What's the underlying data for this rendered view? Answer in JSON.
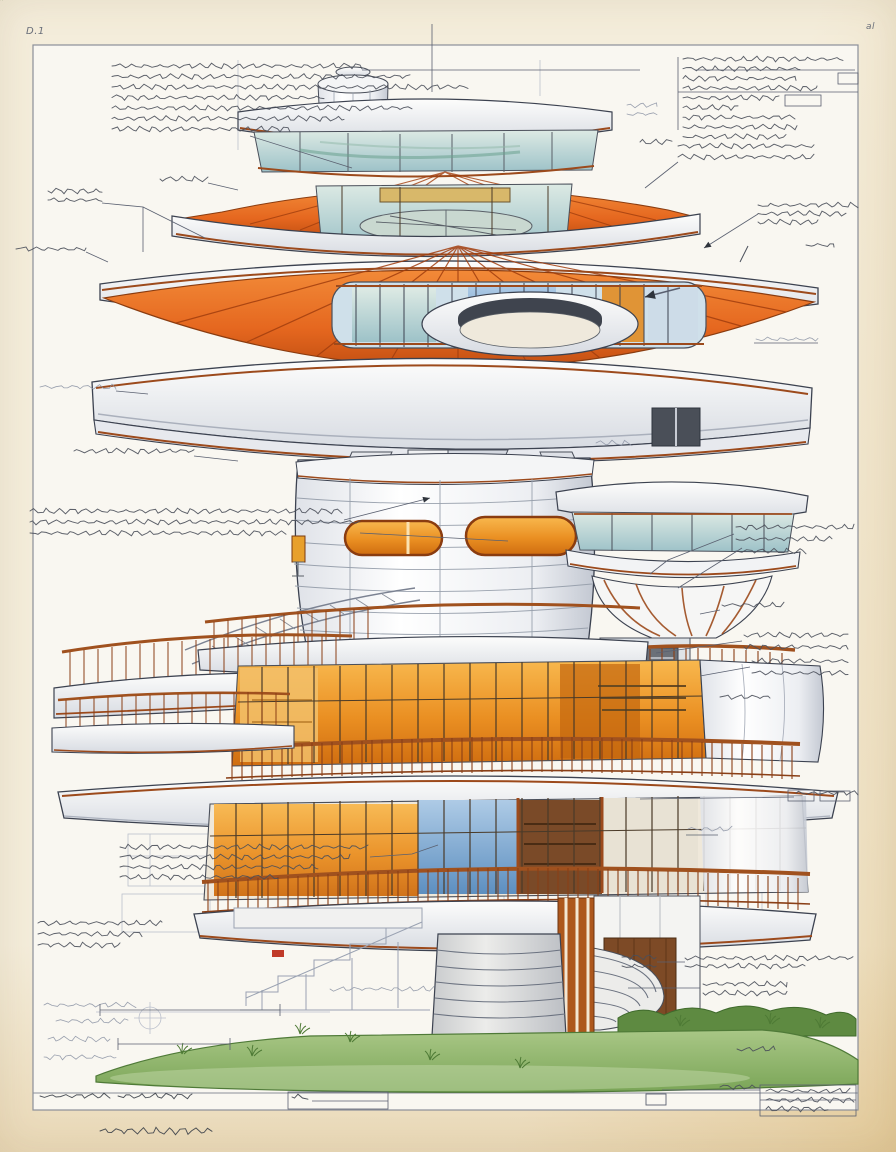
{
  "sheet": {
    "label_top_left": "D.1",
    "label_top_right": "al",
    "palette": {
      "paper_margin": "#f3ead6",
      "paper_inner": "#f9f7f1",
      "frame_line": "#8b8f99",
      "accent_orange": "#e66c22",
      "orange_deep": "#c05314",
      "trim_sienna": "#9c4a1c",
      "ink": "#4a4f5a",
      "pencil": "#8e96a6",
      "dark": "#3a3f48",
      "glass_teal": "#b9d6d4",
      "glass_blue": "#6fa3cf",
      "interior_glow": "#eb9026",
      "grass_green": "#8fb468",
      "concrete": "#d6d8da"
    },
    "annotations": [
      {
        "x": 112,
        "y": 66,
        "w": 250,
        "rows": 7,
        "gap": 10.5,
        "c": "ink",
        "widths": [
          250,
          298,
          356,
          212,
          300,
          232,
          178
        ]
      },
      {
        "x": 683,
        "y": 59,
        "w": 160,
        "rows": 9,
        "gap": 9.7,
        "c": "ink",
        "widths": [
          160,
          117,
          113,
          134,
          96,
          55,
          112,
          114,
          103
        ]
      },
      {
        "x": 678,
        "y": 146,
        "w": 136,
        "rows": 2,
        "gap": 11,
        "c": "ink"
      },
      {
        "x": 640,
        "y": 142,
        "w": 32,
        "rows": 1,
        "gap": 10,
        "c": "ink"
      },
      {
        "x": 627,
        "y": 105,
        "w": 30,
        "rows": 2,
        "gap": 9,
        "c": "pencil"
      },
      {
        "x": 758,
        "y": 205,
        "w": 100,
        "rows": 3,
        "gap": 8.5,
        "c": "ink",
        "widths": [
          100,
          88,
          60
        ]
      },
      {
        "x": 806,
        "y": 245,
        "w": 28,
        "rows": 1,
        "gap": 10,
        "c": "ink"
      },
      {
        "x": 160,
        "y": 179,
        "w": 48,
        "rows": 1,
        "gap": 10,
        "c": "ink"
      },
      {
        "x": 48,
        "y": 191,
        "w": 54,
        "rows": 2,
        "gap": 9,
        "c": "ink"
      },
      {
        "x": 16,
        "y": 249,
        "w": 70,
        "rows": 1,
        "gap": 10,
        "c": "ink"
      },
      {
        "x": 40,
        "y": 387,
        "w": 76,
        "rows": 1,
        "gap": 10,
        "c": "pencil"
      },
      {
        "x": 74,
        "y": 451,
        "w": 120,
        "rows": 1,
        "gap": 10,
        "c": "ink"
      },
      {
        "x": 30,
        "y": 511,
        "w": 312,
        "rows": 3,
        "gap": 11,
        "c": "ink",
        "widths": [
          312,
          330,
          256
        ]
      },
      {
        "x": 736,
        "y": 527,
        "w": 118,
        "rows": 3,
        "gap": 12,
        "c": "ink",
        "widths": [
          118,
          96,
          70
        ]
      },
      {
        "x": 756,
        "y": 339,
        "w": 62,
        "rows": 1,
        "gap": 10,
        "c": "pencil"
      },
      {
        "x": 722,
        "y": 605,
        "w": 62,
        "rows": 1,
        "gap": 10,
        "c": "ink"
      },
      {
        "x": 744,
        "y": 635,
        "w": 104,
        "rows": 2,
        "gap": 12,
        "c": "ink"
      },
      {
        "x": 752,
        "y": 661,
        "w": 96,
        "rows": 2,
        "gap": 12,
        "c": "ink"
      },
      {
        "x": 720,
        "y": 697,
        "w": 50,
        "rows": 1,
        "gap": 10,
        "c": "ink"
      },
      {
        "x": 796,
        "y": 793,
        "w": 62,
        "rows": 1,
        "gap": 10,
        "c": "ink"
      },
      {
        "x": 688,
        "y": 829,
        "w": 44,
        "rows": 1,
        "gap": 10,
        "c": "pencil"
      },
      {
        "x": 596,
        "y": 443,
        "w": 36,
        "rows": 1,
        "gap": 10,
        "c": "pencil"
      },
      {
        "x": 622,
        "y": 957,
        "w": 34,
        "rows": 2,
        "gap": 9,
        "c": "ink"
      },
      {
        "x": 685,
        "y": 958,
        "w": 168,
        "rows": 2,
        "gap": 8,
        "c": "ink",
        "widths": [
          168,
          120
        ]
      },
      {
        "x": 703,
        "y": 984,
        "w": 84,
        "rows": 2,
        "gap": 9,
        "c": "ink"
      },
      {
        "x": 737,
        "y": 1049,
        "w": 38,
        "rows": 1,
        "gap": 10,
        "c": "ink"
      },
      {
        "x": 120,
        "y": 847,
        "w": 248,
        "rows": 4,
        "gap": 10,
        "c": "ink",
        "widths": [
          248,
          230,
          198,
          158
        ]
      },
      {
        "x": 38,
        "y": 923,
        "w": 124,
        "rows": 3,
        "gap": 11,
        "c": "ink",
        "widths": [
          124,
          104,
          82
        ]
      },
      {
        "x": 44,
        "y": 1005,
        "w": 92,
        "rows": 1,
        "gap": 10,
        "c": "pencil"
      },
      {
        "x": 56,
        "y": 1021,
        "w": 72,
        "rows": 1,
        "gap": 10,
        "c": "pencil"
      },
      {
        "x": 48,
        "y": 1039,
        "w": 62,
        "rows": 1,
        "gap": 10,
        "c": "pencil"
      },
      {
        "x": 44,
        "y": 1057,
        "w": 72,
        "rows": 1,
        "gap": 10,
        "c": "pencil"
      },
      {
        "x": 330,
        "y": 989,
        "w": 104,
        "rows": 1,
        "gap": 10,
        "c": "pencil"
      },
      {
        "x": 40,
        "y": 1096,
        "w": 70,
        "rows": 1,
        "gap": 10,
        "c": "dark"
      },
      {
        "x": 118,
        "y": 1096,
        "w": 74,
        "rows": 1,
        "gap": 10,
        "c": "dark"
      },
      {
        "x": 292,
        "y": 1097,
        "w": 16,
        "rows": 1,
        "gap": 10,
        "c": "dark"
      },
      {
        "x": 720,
        "y": 1087,
        "w": 40,
        "rows": 1,
        "gap": 10,
        "c": "ink"
      },
      {
        "x": 766,
        "y": 1091,
        "w": 84,
        "rows": 3,
        "gap": 9,
        "c": "ink",
        "widths": [
          84,
          88,
          62
        ]
      },
      {
        "x": 100,
        "y": 1131,
        "w": 112,
        "rows": 1,
        "gap": 10,
        "c": "dark",
        "amp": 3
      }
    ],
    "leader_lines": [
      {
        "p": [
          [
            362,
            70
          ],
          [
            640,
            70
          ]
        ]
      },
      {
        "p": [
          [
            695,
            70
          ],
          [
            855,
            70
          ]
        ]
      },
      {
        "p": [
          [
            678,
            57
          ],
          [
            678,
            130
          ]
        ]
      },
      {
        "p": [
          [
            678,
            92
          ],
          [
            858,
            92
          ]
        ]
      },
      {
        "p": [
          [
            250,
            136
          ],
          [
            352,
            168
          ]
        ]
      },
      {
        "p": [
          [
            208,
            183
          ],
          [
            238,
            190
          ]
        ]
      },
      {
        "p": [
          [
            102,
            203
          ],
          [
            143,
            207
          ],
          [
            143,
            252
          ]
        ]
      },
      {
        "p": [
          [
            143,
            207
          ],
          [
            205,
            238
          ]
        ]
      },
      {
        "p": [
          [
            86,
            252
          ],
          [
            108,
            262
          ]
        ]
      },
      {
        "p": [
          [
            678,
            162
          ],
          [
            645,
            188
          ]
        ]
      },
      {
        "p": [
          [
            758,
            214
          ],
          [
            704,
            248
          ]
        ],
        "arrow": true
      },
      {
        "p": [
          [
            680,
            288
          ],
          [
            645,
            297
          ]
        ],
        "arrow": true,
        "bold": true
      },
      {
        "p": [
          [
            818,
            343
          ],
          [
            754,
            343
          ]
        ]
      },
      {
        "p": [
          [
            116,
            391
          ],
          [
            148,
            394
          ]
        ]
      },
      {
        "p": [
          [
            194,
            456
          ],
          [
            238,
            461
          ]
        ]
      },
      {
        "p": [
          [
            344,
            520
          ],
          [
            430,
            498
          ]
        ],
        "arrow": true
      },
      {
        "p": [
          [
            360,
            533
          ],
          [
            508,
            541
          ]
        ]
      },
      {
        "p": [
          [
            734,
            534
          ],
          [
            668,
            560
          ],
          [
            650,
            574
          ]
        ]
      },
      {
        "p": [
          [
            742,
            548
          ],
          [
            678,
            588
          ]
        ]
      },
      {
        "p": [
          [
            720,
            610
          ],
          [
            700,
            614
          ]
        ]
      },
      {
        "p": [
          [
            742,
            641
          ],
          [
            656,
            653
          ]
        ]
      },
      {
        "p": [
          [
            750,
            667
          ],
          [
            700,
            676
          ]
        ]
      },
      {
        "p": [
          [
            640,
            799
          ],
          [
            794,
            797
          ]
        ]
      },
      {
        "p": [
          [
            686,
            835
          ],
          [
            718,
            835
          ]
        ]
      },
      {
        "p": [
          [
            657,
            962
          ],
          [
            685,
            962
          ]
        ]
      },
      {
        "p": [
          [
            628,
            988
          ],
          [
            700,
            988
          ]
        ]
      },
      {
        "p": [
          [
            370,
            857
          ],
          [
            412,
            854
          ],
          [
            438,
            845
          ]
        ]
      },
      {
        "p": [
          [
            100,
            1010
          ],
          [
            280,
            1010
          ]
        ]
      },
      {
        "p": [
          [
            100,
            1004
          ],
          [
            100,
            1016
          ]
        ]
      },
      {
        "p": [
          [
            280,
            1004
          ],
          [
            280,
            1016
          ]
        ]
      },
      {
        "p": [
          [
            118,
            1044
          ],
          [
            230,
            1044
          ]
        ]
      },
      {
        "p": [
          [
            118,
            1038
          ],
          [
            118,
            1050
          ]
        ]
      },
      {
        "p": [
          [
            230,
            1038
          ],
          [
            230,
            1050
          ]
        ]
      },
      {
        "p": [
          [
            662,
            1090
          ],
          [
            760,
            1090
          ]
        ]
      },
      {
        "p": [
          [
            312,
            1101
          ],
          [
            388,
            1101
          ]
        ]
      },
      {
        "p": [
          [
            760,
            1100
          ],
          [
            856,
            1100
          ]
        ]
      },
      {
        "p": [
          [
            432,
            24
          ],
          [
            432,
            92
          ]
        ]
      }
    ],
    "boxes": [
      {
        "x": 838,
        "y": 73,
        "w": 20,
        "h": 11
      },
      {
        "x": 785,
        "y": 95,
        "w": 36,
        "h": 11
      },
      {
        "x": 788,
        "y": 790,
        "w": 26,
        "h": 11
      },
      {
        "x": 820,
        "y": 791,
        "w": 30,
        "h": 10
      },
      {
        "x": 288,
        "y": 1092,
        "w": 100,
        "h": 17
      },
      {
        "x": 760,
        "y": 1085,
        "w": 96,
        "h": 31
      }
    ]
  }
}
